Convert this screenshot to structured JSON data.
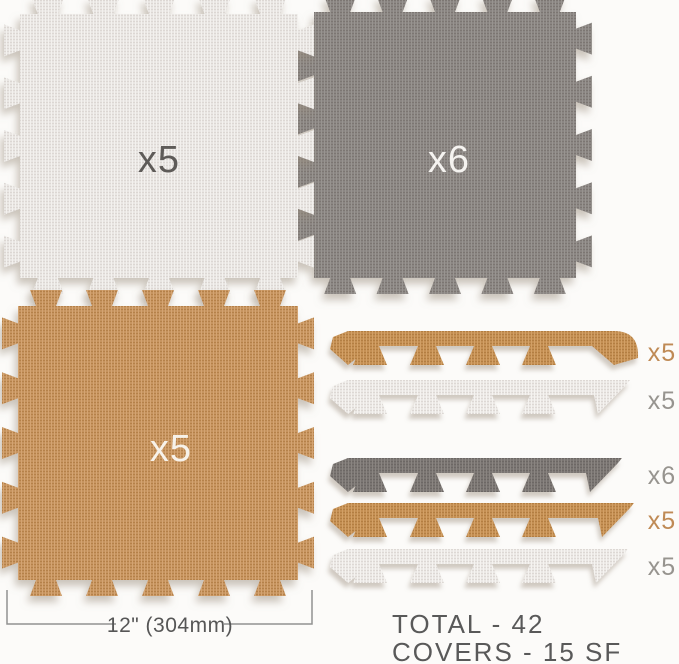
{
  "colors": {
    "background": "#fcfbf9",
    "tile_white": "#e9e6e3",
    "tile_gray": "#8b8683",
    "tile_tan": "#c6945f",
    "strip_white": "#ebe8e5",
    "strip_dark": "#7a7572",
    "strip_tan": "#c48f53",
    "label_on_white_tile": "#5e5b58",
    "label_on_gray_tile": "#f5f3f0",
    "label_on_tan_tile": "#f7f2ea",
    "strip_label_tan": "#bf8a55",
    "strip_label_gray": "#97948f",
    "dimension_line": "#919191",
    "dimension_text": "#565656",
    "summary_text": "#595959"
  },
  "tiles": [
    {
      "name": "white-full-tile",
      "label": "x5",
      "count": 5
    },
    {
      "name": "gray-full-tile",
      "label": "x6",
      "count": 6
    },
    {
      "name": "tan-full-tile",
      "label": "x5",
      "count": 5
    }
  ],
  "strips": [
    {
      "name": "tan-corner-edge-strip",
      "label": "x5",
      "count": 5
    },
    {
      "name": "white-edge-strip-1",
      "label": "x5",
      "count": 5
    },
    {
      "name": "gray-edge-strip",
      "label": "x6",
      "count": 6
    },
    {
      "name": "tan-edge-strip",
      "label": "x5",
      "count": 5
    },
    {
      "name": "white-edge-strip-2",
      "label": "x5",
      "count": 5
    }
  ],
  "dimension": {
    "label": "12\" (304mm)"
  },
  "summary": {
    "total_line": "TOTAL - 42",
    "covers_line": "COVERS - 15 SF"
  }
}
